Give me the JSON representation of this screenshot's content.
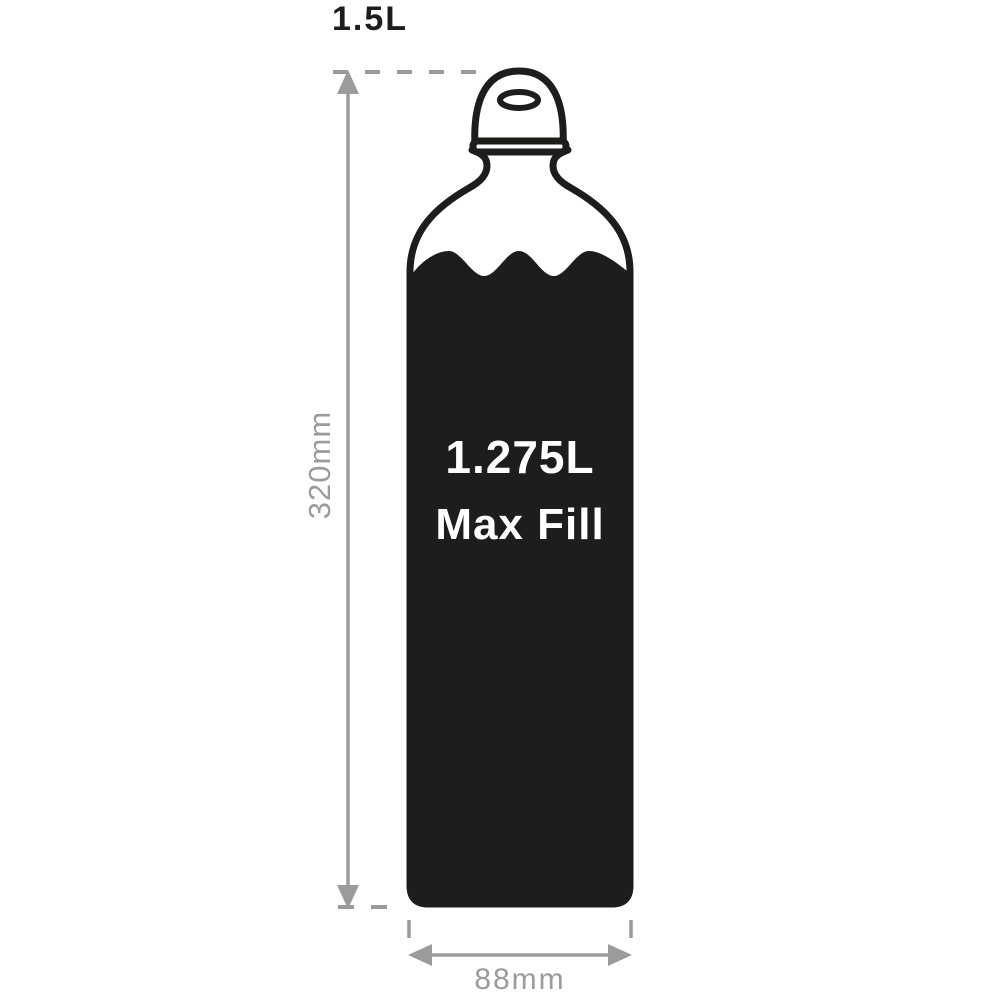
{
  "diagram": {
    "type": "bottle-dimension-diagram",
    "capacity_label": "1.5L",
    "height_dimension_label": "320mm",
    "width_dimension_label": "88mm",
    "max_fill": {
      "volume": "1.275L",
      "caption": "Max Fill"
    },
    "colors": {
      "background": "#ffffff",
      "bottle_outline": "#1d1d1b",
      "water_fill": "#1d1d1b",
      "fill_text": "#ffffff",
      "dimension_gray": "#9b9b9a"
    }
  }
}
